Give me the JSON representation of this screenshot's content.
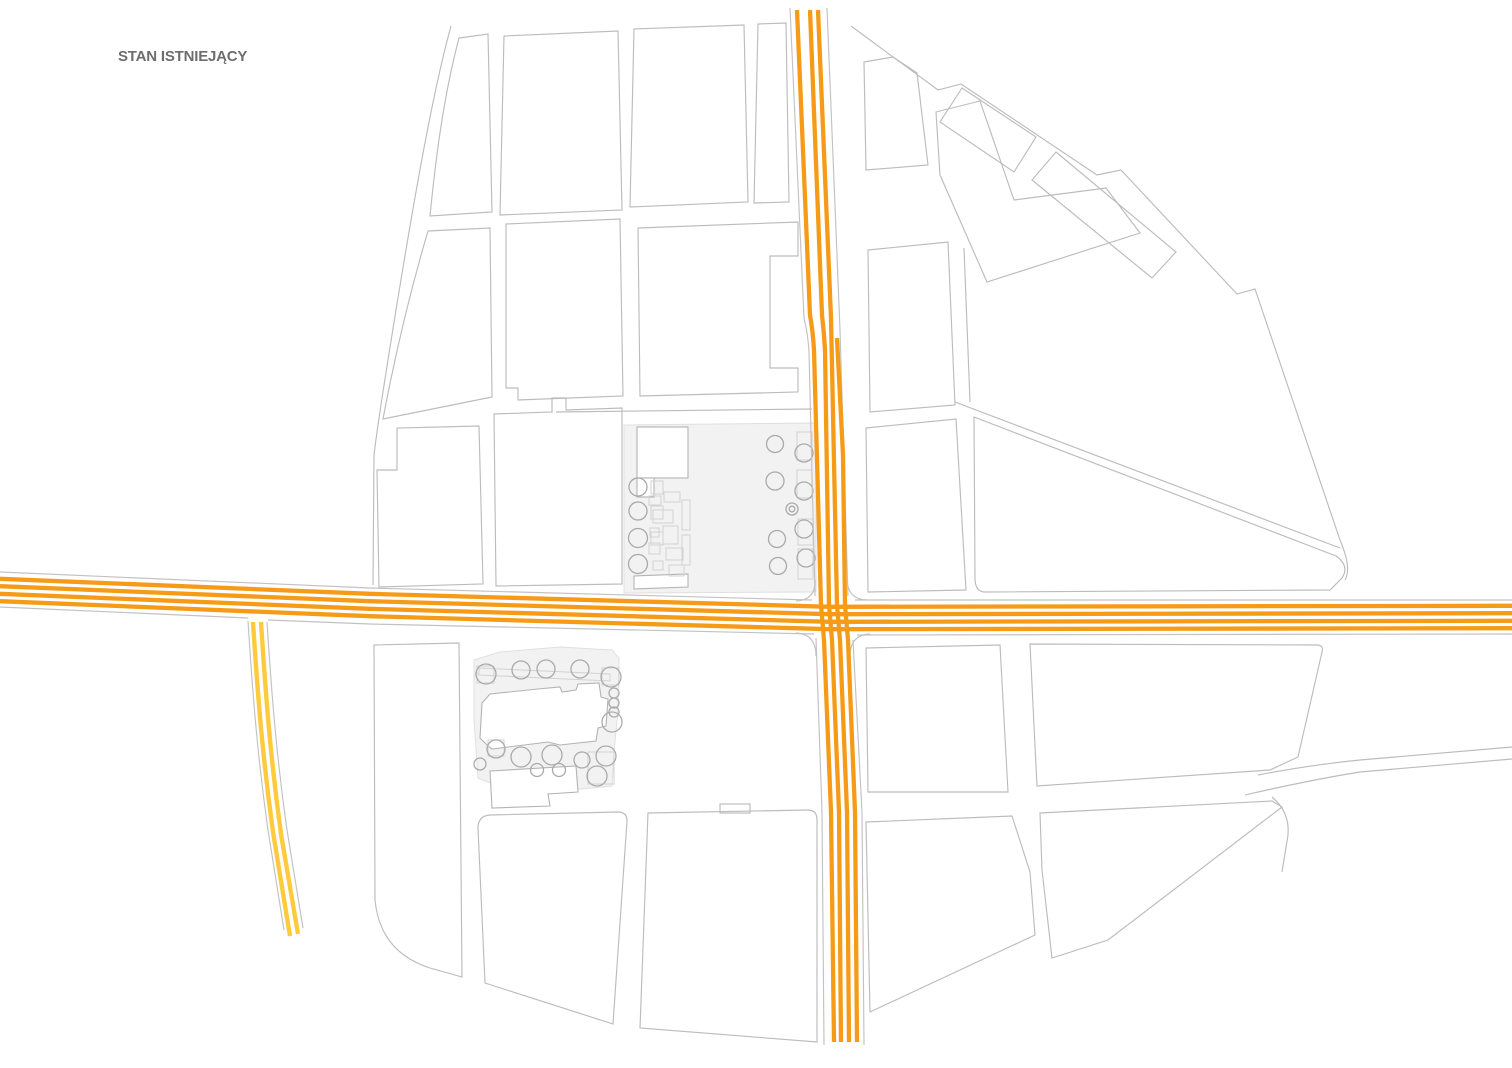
{
  "title": {
    "text": "STAN ISTNIEJĄCY",
    "color": "#6d6d6d"
  },
  "colors": {
    "background": "#ffffff",
    "line": "#bcbcbc",
    "line_light": "#d2d2d2",
    "plaza_fill": "#f2f2f2",
    "plaza_stroke": "#e0e0e0",
    "building_stroke": "#b3b3b3",
    "tree_stroke": "#aaaaaa",
    "road_casing": "#c2c2c2",
    "road_primary": "#F59B18",
    "road_secondary": "#FFCB3D"
  },
  "roads": {
    "primary_horizontal": {
      "name": "main road east-west",
      "color": "#F59B18",
      "stripes": 4
    },
    "primary_vertical": {
      "name": "main road north-south",
      "color": "#F59B18",
      "stripes": 4
    },
    "secondary_branch": {
      "name": "secondary road south-west branch",
      "color": "#FFCB3D",
      "stripes": 2
    }
  },
  "map": {
    "type": "urban plan - existing state",
    "plazas": [
      {
        "name": "main square",
        "trees": 13
      },
      {
        "name": "church square",
        "trees": 17
      }
    ]
  }
}
